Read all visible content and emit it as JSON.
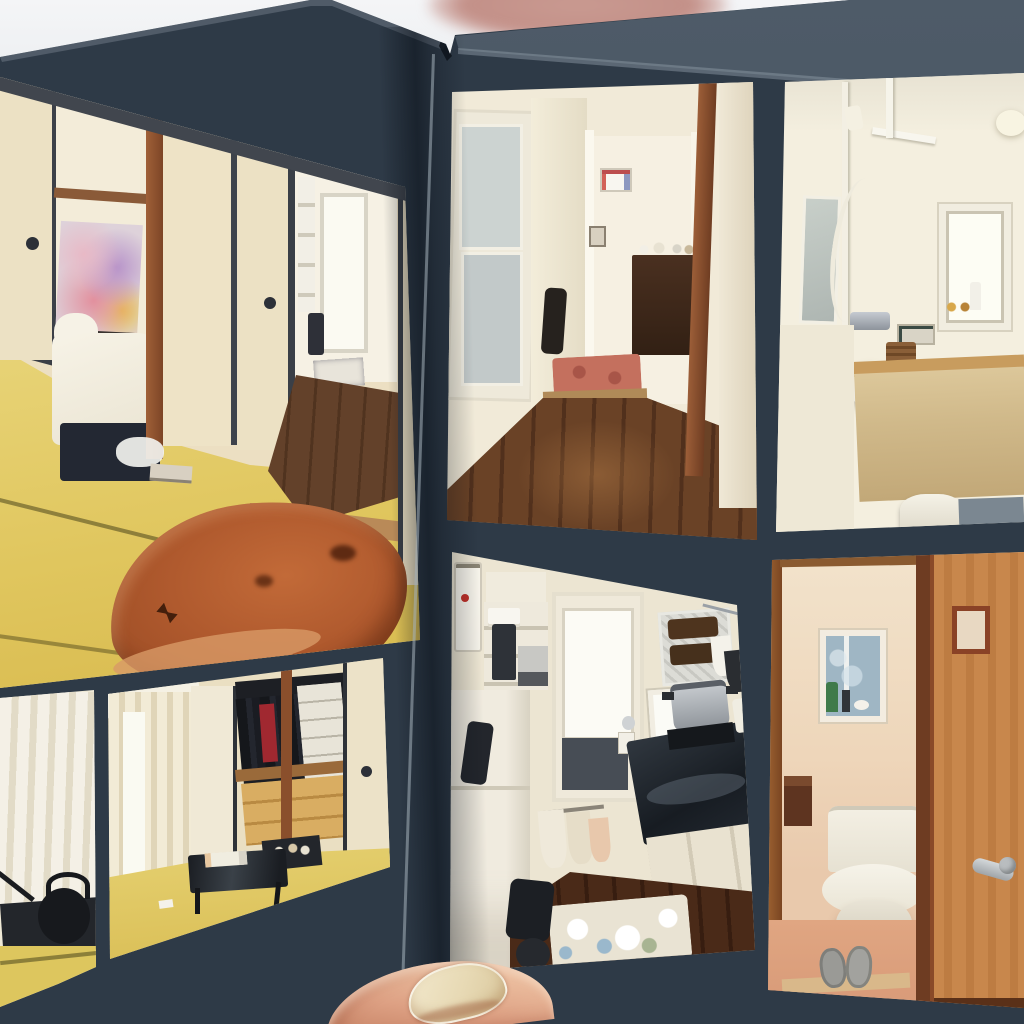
{
  "scene": {
    "type": "photograph",
    "description": "A thumb holds open a dark navy photo album. Two facing pages display seven printed photos of a small Japanese apartment, shot at a tilted perspective against a bright white background with a blurred pink object at the top.",
    "background_color": "#f2f3f5",
    "blur_object_color": "#c99a91"
  },
  "album": {
    "page_color": "#2e3a47",
    "gutter_shadow_color": "#101a26",
    "page_edge_highlight": "#93a0aa",
    "left_page_label": "left album page with three photos",
    "right_page_label": "right album page with four photos",
    "gutter_label": "album spine gutter"
  },
  "photos": [
    {
      "id": "bedroom-tatami",
      "page": "left",
      "label": "Tatami bedroom: bed with white duvet and floral art, cream fusuma sliding doors, wood pillars, open doorway to a wooden hallway, and a live-edge wooden slab table on yellow tatami",
      "palette": {
        "tatami": "#e3cd66",
        "fusuma": "#ece1c4",
        "pillar": "#9a5a36",
        "table": "#b05a2e"
      }
    },
    {
      "id": "curtain-teapot",
      "page": "left",
      "label": "Detail photo: white curtain with a black cast-iron teapot on tatami",
      "palette": {
        "curtain": "#f0ead8",
        "teapot": "#17191d"
      }
    },
    {
      "id": "closet-room",
      "page": "left",
      "label": "Tatami room with window curtains, open closet of hanging clothes and storage boxes, wooden drawers, and a low black table with a tray",
      "palette": {
        "closet_wood": "#d9ad62",
        "red_garment": "#a02830"
      }
    },
    {
      "id": "hallway",
      "page": "right",
      "label": "Narrow wooden hallway leading to a lit room with a dark dresser, small frames, a red rug and a diagonal wood beam",
      "palette": {
        "floor": "#5d3a22",
        "rug": "#c4705e"
      }
    },
    {
      "id": "bathroom",
      "page": "right",
      "label": "Bathroom with bright recessed window, mirror, white shower pole and hose, fluffy loofah, control panel, sand-colored bathtub and white stool",
      "palette": {
        "tub": "#d0b98a",
        "wall": "#f4efdf"
      }
    },
    {
      "id": "kitchen",
      "page": "right",
      "label": "Compact kitchen: white fridge and shelves with coffee maker, glass back door, foil backsplash, bright window, steel pot on stove, dark counter, towels and floral mat on dark wood floor",
      "palette": {
        "counter": "#262c33",
        "mat": "#e9e3d3"
      }
    },
    {
      "id": "toilet-room",
      "page": "right",
      "label": "Toilet room seen through an open orange wooden door with silver lever handle: small blue window with bottles on the sill, white toilet, paper holder and grey slippers on a salmon pink floor",
      "palette": {
        "door": "#c8874c",
        "floor": "#dd9e7c"
      }
    }
  ],
  "hand": {
    "label": "thumb with visible fingernail holding the album open at bottom center",
    "skin_color": "#e0a88a",
    "nail_color": "#e7d9b4"
  }
}
